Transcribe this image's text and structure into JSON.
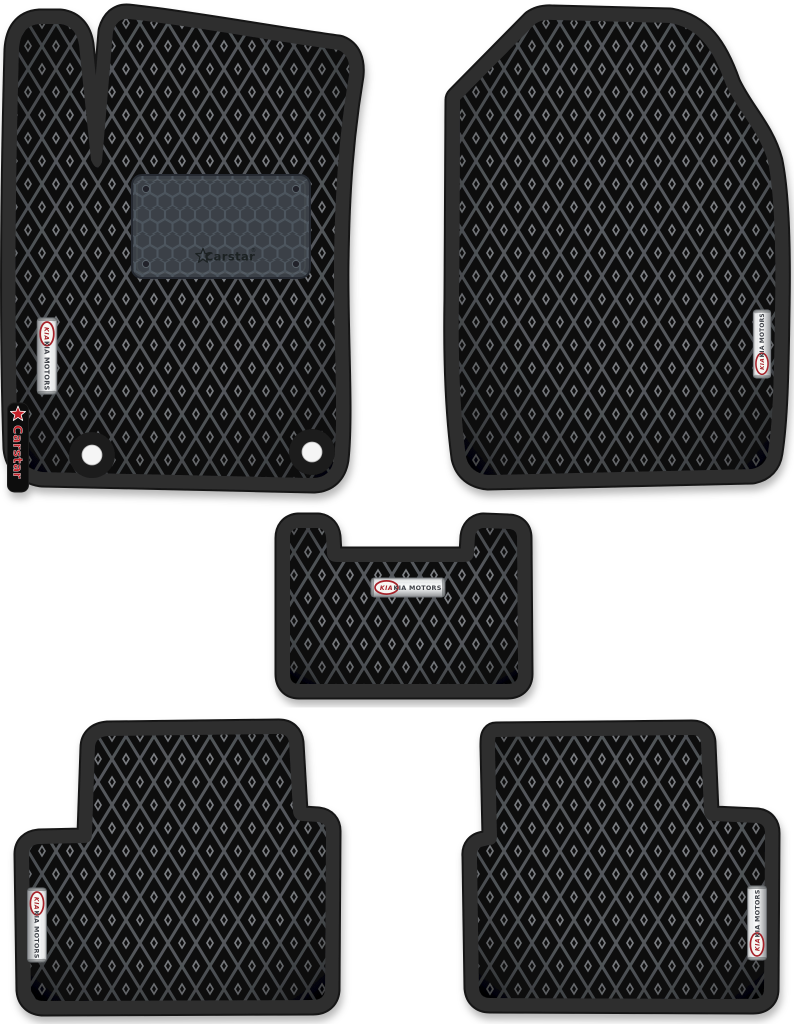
{
  "badge": {
    "kia_logo_text": "KIA",
    "brand_text": "KIA MOTORS"
  },
  "heel_pad": {
    "logo_text": "Carstar",
    "registered_mark": "®"
  },
  "side_label": {
    "logo_text": "Carstar"
  },
  "icons": {
    "star": "star-icon",
    "kia_logo_oval": "kia-logo-oval"
  },
  "colors": {
    "background": "#ffffff",
    "mat_surface": "#0b0b0c",
    "mat_lattice": "#5c5f63",
    "mat_trim": "#2d2d2e",
    "mat_trim_edge": "#181818",
    "heel_pad": "#3a4046",
    "badge_silver": "#e9eaeb",
    "kia_red": "#a6242a",
    "carstar_red": "#c4242b",
    "fastener_white": "#f5f5f5"
  }
}
